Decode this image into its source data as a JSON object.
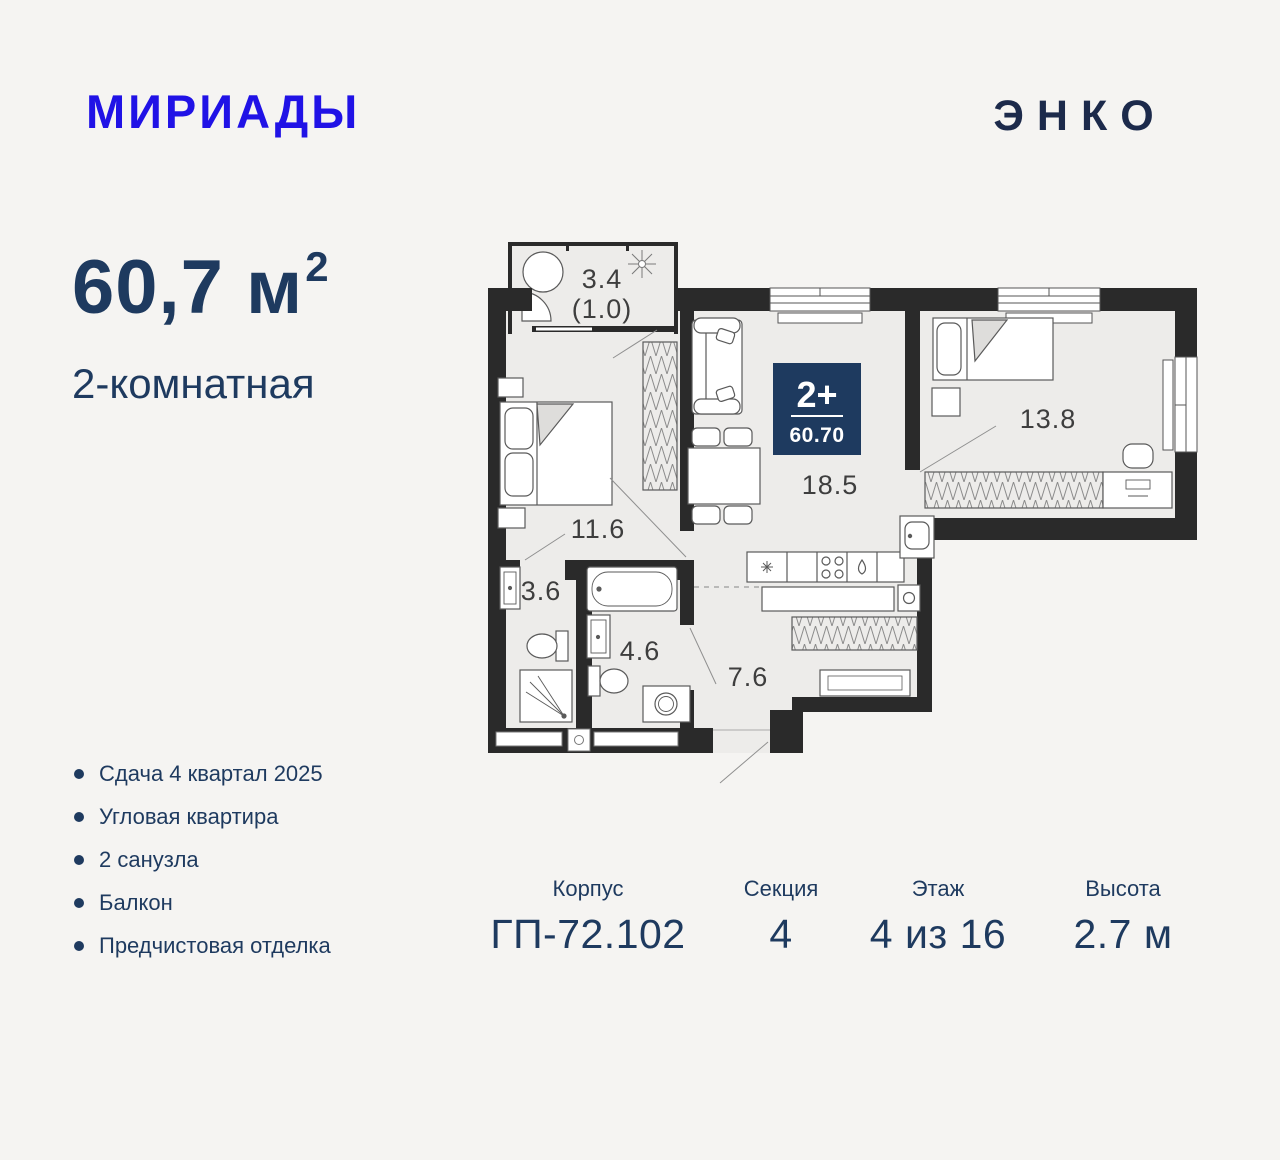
{
  "header": {
    "brand": "МИРИАДЫ",
    "developer": "ЭНКО"
  },
  "summary": {
    "area": "60,7 м",
    "area_sup": "2",
    "type": "2-комнатная"
  },
  "features": [
    "Сдача 4 квартал 2025",
    "Угловая квартира",
    "2 санузла",
    "Балкон",
    "Предчистовая отделка"
  ],
  "details": {
    "items": [
      {
        "label": "Корпус",
        "value": "ГП-72.102"
      },
      {
        "label": "Секция",
        "value": "4"
      },
      {
        "label": "Этаж",
        "value": "4 из 16"
      },
      {
        "label": "Высота",
        "value": "2.7 м"
      }
    ]
  },
  "plan": {
    "badge": {
      "rooms": "2+",
      "area": "60.70"
    },
    "rooms": {
      "balcony": {
        "label": "3.4",
        "sublabel": "(1.0)"
      },
      "bedroom1": {
        "label": "11.6"
      },
      "bath1": {
        "label": "3.6"
      },
      "bath2": {
        "label": "4.6"
      },
      "hall": {
        "label": "7.6"
      },
      "living": {
        "label": "18.5"
      },
      "bedroom2": {
        "label": "13.8"
      }
    }
  },
  "colors": {
    "background": "#f5f4f2",
    "brand_blue": "#2012e6",
    "navy": "#1e3a5f",
    "developer_navy": "#1c2a4b",
    "wall": "#2a2a2a",
    "floor": "#edecea"
  }
}
